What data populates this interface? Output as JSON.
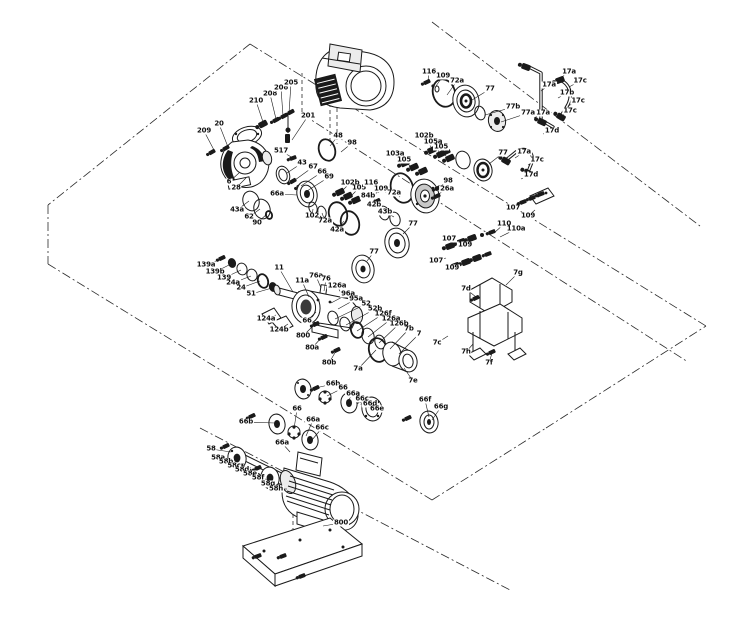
{
  "figure": {
    "type": "exploded-parts-diagram",
    "subject": "pump assembly exploded service drawing"
  },
  "colors": {
    "line": "#1a1a1a",
    "background": "#ffffff"
  },
  "parts": [
    {
      "t": "209",
      "x": 204,
      "y": 131,
      "tx": 215,
      "ty": 152
    },
    {
      "t": "20",
      "x": 219,
      "y": 124,
      "tx": 228,
      "ty": 147
    },
    {
      "t": "210",
      "x": 256,
      "y": 101,
      "tx": 263,
      "ty": 122
    },
    {
      "t": "208",
      "x": 270,
      "y": 94,
      "tx": 276,
      "ty": 119
    },
    {
      "t": "206",
      "x": 281,
      "y": 88,
      "tx": 283,
      "ty": 116
    },
    {
      "t": "205",
      "x": 291,
      "y": 83,
      "tx": 289,
      "ty": 113
    },
    {
      "t": "201",
      "x": 308,
      "y": 116,
      "tx": 292,
      "ty": 140
    },
    {
      "t": "517",
      "x": 281,
      "y": 151,
      "tx": 293,
      "ty": 158
    },
    {
      "t": "6",
      "x": 229,
      "y": 182,
      "tx": 239,
      "ty": 173
    },
    {
      "t": "28",
      "x": 236,
      "y": 188,
      "tx": 246,
      "ty": 178
    },
    {
      "t": "48",
      "x": 338,
      "y": 136,
      "tx": 330,
      "ty": 146
    },
    {
      "t": "98",
      "x": 352,
      "y": 143,
      "tx": 341,
      "ty": 152
    },
    {
      "t": "43",
      "x": 302,
      "y": 163,
      "tx": 287,
      "ty": 173
    },
    {
      "t": "67",
      "x": 313,
      "y": 167,
      "tx": 295,
      "ty": 180
    },
    {
      "t": "66",
      "x": 322,
      "y": 172,
      "tx": 301,
      "ty": 186
    },
    {
      "t": "69",
      "x": 329,
      "y": 177,
      "tx": 307,
      "ty": 191
    },
    {
      "t": "66a",
      "x": 277,
      "y": 194,
      "tx": 297,
      "ty": 195
    },
    {
      "t": "43a",
      "x": 237,
      "y": 210,
      "tx": 249,
      "ty": 201
    },
    {
      "t": "62",
      "x": 249,
      "y": 217,
      "tx": 260,
      "ty": 209
    },
    {
      "t": "90",
      "x": 257,
      "y": 223,
      "tx": 267,
      "ty": 214
    },
    {
      "t": "102",
      "x": 312,
      "y": 216,
      "tx": 313,
      "ty": 209
    },
    {
      "t": "72a",
      "x": 325,
      "y": 221,
      "tx": 322,
      "ty": 213
    },
    {
      "t": "116",
      "x": 429,
      "y": 72,
      "tx": 428,
      "ty": 81
    },
    {
      "t": "109",
      "x": 443,
      "y": 76,
      "tx": 436,
      "ty": 86
    },
    {
      "t": "72a",
      "x": 457,
      "y": 81,
      "tx": 447,
      "ty": 95
    },
    {
      "t": "77",
      "x": 490,
      "y": 89,
      "tx": 472,
      "ty": 100
    },
    {
      "t": "77b",
      "x": 513,
      "y": 107,
      "tx": 485,
      "ty": 115
    },
    {
      "t": "77a",
      "x": 528,
      "y": 113,
      "tx": 501,
      "ty": 122
    },
    {
      "t": "17a",
      "x": 569,
      "y": 72,
      "tx": 559,
      "ty": 79
    },
    {
      "t": "17c",
      "x": 580,
      "y": 81,
      "tx": 569,
      "ty": 87
    },
    {
      "t": "17a",
      "x": 549,
      "y": 85,
      "tx": 541,
      "ty": 91
    },
    {
      "t": "17b",
      "x": 567,
      "y": 93,
      "tx": 558,
      "ty": 98
    },
    {
      "t": "17c",
      "x": 578,
      "y": 101,
      "tx": 568,
      "ty": 106
    },
    {
      "t": "17a",
      "x": 543,
      "y": 113,
      "tx": 534,
      "ty": 118
    },
    {
      "t": "17c",
      "x": 570,
      "y": 111,
      "tx": 560,
      "ty": 116
    },
    {
      "t": "17d",
      "x": 552,
      "y": 131,
      "tx": 543,
      "ty": 134
    },
    {
      "t": "102b",
      "x": 424,
      "y": 136,
      "tx": 431,
      "ty": 147
    },
    {
      "t": "105a",
      "x": 433,
      "y": 142,
      "tx": 439,
      "ty": 152
    },
    {
      "t": "105",
      "x": 441,
      "y": 147,
      "tx": 446,
      "ty": 156
    },
    {
      "t": "103a",
      "x": 395,
      "y": 154,
      "tx": 404,
      "ty": 163
    },
    {
      "t": "105",
      "x": 404,
      "y": 160,
      "tx": 411,
      "ty": 167
    },
    {
      "t": "102b",
      "x": 350,
      "y": 183,
      "tx": 342,
      "ty": 191
    },
    {
      "t": "105",
      "x": 359,
      "y": 188,
      "tx": 351,
      "ty": 196
    },
    {
      "t": "116",
      "x": 371,
      "y": 183,
      "tx": 380,
      "ty": 189
    },
    {
      "t": "109",
      "x": 381,
      "y": 189,
      "tx": 388,
      "ty": 194
    },
    {
      "t": "72a",
      "x": 394,
      "y": 193,
      "tx": 400,
      "ty": 197
    },
    {
      "t": "84b",
      "x": 368,
      "y": 196,
      "tx": 377,
      "ty": 201
    },
    {
      "t": "42b",
      "x": 374,
      "y": 205,
      "tx": 383,
      "ty": 211
    },
    {
      "t": "43b",
      "x": 385,
      "y": 212,
      "tx": 394,
      "ty": 217
    },
    {
      "t": "42a",
      "x": 337,
      "y": 230,
      "tx": 344,
      "ty": 221
    },
    {
      "t": "98",
      "x": 448,
      "y": 181,
      "tx": 438,
      "ty": 188
    },
    {
      "t": "26a",
      "x": 447,
      "y": 189,
      "tx": 437,
      "ty": 195
    },
    {
      "t": "77",
      "x": 503,
      "y": 153,
      "tx": 489,
      "ty": 164
    },
    {
      "t": "17a",
      "x": 524,
      "y": 152,
      "tx": 515,
      "ty": 158
    },
    {
      "t": "17c",
      "x": 537,
      "y": 160,
      "tx": 528,
      "ty": 165
    },
    {
      "t": "17d",
      "x": 531,
      "y": 175,
      "tx": 521,
      "ty": 179
    },
    {
      "t": "110",
      "x": 504,
      "y": 224,
      "tx": 494,
      "ty": 233
    },
    {
      "t": "110a",
      "x": 516,
      "y": 229,
      "tx": 500,
      "ty": 237
    },
    {
      "t": "107",
      "x": 449,
      "y": 239,
      "tx": 457,
      "ty": 242
    },
    {
      "t": "109",
      "x": 465,
      "y": 245,
      "tx": 470,
      "ty": 240
    },
    {
      "t": "107",
      "x": 436,
      "y": 261,
      "tx": 446,
      "ty": 258
    },
    {
      "t": "109",
      "x": 452,
      "y": 268,
      "tx": 461,
      "ty": 263
    },
    {
      "t": "107",
      "x": 513,
      "y": 208,
      "tx": 521,
      "ty": 203
    },
    {
      "t": "109",
      "x": 528,
      "y": 216,
      "tx": 535,
      "ty": 210
    },
    {
      "t": "77",
      "x": 413,
      "y": 224,
      "tx": 403,
      "ty": 234
    },
    {
      "t": "77",
      "x": 374,
      "y": 252,
      "tx": 367,
      "ty": 261
    },
    {
      "t": "139a",
      "x": 206,
      "y": 265,
      "tx": 221,
      "ty": 259
    },
    {
      "t": "139b",
      "x": 215,
      "y": 272,
      "tx": 231,
      "ty": 264
    },
    {
      "t": "139",
      "x": 224,
      "y": 278,
      "tx": 241,
      "ty": 270
    },
    {
      "t": "24a",
      "x": 233,
      "y": 283,
      "tx": 251,
      "ty": 276
    },
    {
      "t": "24",
      "x": 241,
      "y": 288,
      "tx": 260,
      "ty": 281
    },
    {
      "t": "51",
      "x": 251,
      "y": 294,
      "tx": 272,
      "ty": 288
    },
    {
      "t": "11",
      "x": 279,
      "y": 268,
      "tx": 293,
      "ty": 292
    },
    {
      "t": "11a",
      "x": 302,
      "y": 281,
      "tx": 309,
      "ty": 297
    },
    {
      "t": "76a",
      "x": 316,
      "y": 276,
      "tx": 321,
      "ty": 288
    },
    {
      "t": "76",
      "x": 326,
      "y": 279,
      "tx": 324,
      "ty": 291
    },
    {
      "t": "126a",
      "x": 337,
      "y": 286,
      "tx": 344,
      "ty": 298
    },
    {
      "t": "96a",
      "x": 348,
      "y": 294,
      "tx": 331,
      "ty": 303
    },
    {
      "t": "95a",
      "x": 356,
      "y": 299,
      "tx": 338,
      "ty": 309
    },
    {
      "t": "52",
      "x": 366,
      "y": 304,
      "tx": 335,
      "ty": 319
    },
    {
      "t": "52b",
      "x": 375,
      "y": 309,
      "tx": 346,
      "ty": 325
    },
    {
      "t": "126f",
      "x": 383,
      "y": 314,
      "tx": 357,
      "ty": 331
    },
    {
      "t": "126a",
      "x": 391,
      "y": 319,
      "tx": 368,
      "ty": 337
    },
    {
      "t": "126b",
      "x": 399,
      "y": 324,
      "tx": 379,
      "ty": 343
    },
    {
      "t": "7b",
      "x": 409,
      "y": 329,
      "tx": 390,
      "ty": 349
    },
    {
      "t": "7",
      "x": 419,
      "y": 334,
      "tx": 399,
      "ty": 354
    },
    {
      "t": "124a",
      "x": 266,
      "y": 319,
      "tx": 276,
      "ty": 315
    },
    {
      "t": "124b",
      "x": 279,
      "y": 330,
      "tx": 288,
      "ty": 324
    },
    {
      "t": "66",
      "x": 307,
      "y": 321,
      "tx": 316,
      "ty": 312
    },
    {
      "t": "800",
      "x": 303,
      "y": 336,
      "tx": 314,
      "ty": 325
    },
    {
      "t": "80a",
      "x": 312,
      "y": 348,
      "tx": 322,
      "ty": 337
    },
    {
      "t": "80b",
      "x": 329,
      "y": 363,
      "tx": 336,
      "ty": 351
    },
    {
      "t": "7a",
      "x": 358,
      "y": 369,
      "tx": 376,
      "ty": 350
    },
    {
      "t": "7e",
      "x": 413,
      "y": 381,
      "tx": 404,
      "ty": 368
    },
    {
      "t": "7g",
      "x": 518,
      "y": 273,
      "tx": 506,
      "ty": 285
    },
    {
      "t": "7d",
      "x": 466,
      "y": 289,
      "tx": 476,
      "ty": 297
    },
    {
      "t": "7c",
      "x": 437,
      "y": 343,
      "tx": 448,
      "ty": 336
    },
    {
      "t": "7h",
      "x": 466,
      "y": 352,
      "tx": 473,
      "ty": 344
    },
    {
      "t": "7f",
      "x": 489,
      "y": 363,
      "tx": 492,
      "ty": 353
    },
    {
      "t": "66b",
      "x": 333,
      "y": 384,
      "tx": 311,
      "ty": 389
    },
    {
      "t": "66",
      "x": 343,
      "y": 388,
      "tx": 327,
      "ty": 396
    },
    {
      "t": "66a",
      "x": 353,
      "y": 394,
      "tx": 347,
      "ty": 402
    },
    {
      "t": "66c",
      "x": 362,
      "y": 399,
      "tx": 361,
      "ty": 405
    },
    {
      "t": "66d",
      "x": 370,
      "y": 404,
      "tx": 369,
      "ty": 408
    },
    {
      "t": "66e",
      "x": 377,
      "y": 409,
      "tx": 374,
      "ty": 412
    },
    {
      "t": "66f",
      "x": 425,
      "y": 400,
      "tx": 429,
      "ty": 417
    },
    {
      "t": "66g",
      "x": 441,
      "y": 407,
      "tx": 432,
      "ty": 420
    },
    {
      "t": "66b",
      "x": 246,
      "y": 422,
      "tx": 275,
      "ty": 423
    },
    {
      "t": "66",
      "x": 297,
      "y": 409,
      "tx": 294,
      "ty": 429
    },
    {
      "t": "66a",
      "x": 313,
      "y": 420,
      "tx": 306,
      "ty": 436
    },
    {
      "t": "66c",
      "x": 322,
      "y": 428,
      "tx": 312,
      "ty": 440
    },
    {
      "t": "58",
      "x": 211,
      "y": 449,
      "tx": 231,
      "ty": 452
    },
    {
      "t": "58a",
      "x": 218,
      "y": 458,
      "tx": 237,
      "ty": 459
    },
    {
      "t": "58b",
      "x": 226,
      "y": 462,
      "tx": 244,
      "ty": 464
    },
    {
      "t": "58c",
      "x": 234,
      "y": 466,
      "tx": 251,
      "ty": 468
    },
    {
      "t": "58d",
      "x": 242,
      "y": 470,
      "tx": 258,
      "ty": 472
    },
    {
      "t": "58e",
      "x": 250,
      "y": 474,
      "tx": 265,
      "ty": 476
    },
    {
      "t": "58f",
      "x": 258,
      "y": 478,
      "tx": 272,
      "ty": 480
    },
    {
      "t": "58g",
      "x": 268,
      "y": 484,
      "tx": 280,
      "ty": 485
    },
    {
      "t": "58h",
      "x": 276,
      "y": 489,
      "tx": 287,
      "ty": 489
    },
    {
      "t": "66a",
      "x": 282,
      "y": 443,
      "tx": 290,
      "ty": 452
    },
    {
      "t": "800",
      "x": 341,
      "y": 523,
      "tx": 323,
      "ty": 526
    }
  ]
}
